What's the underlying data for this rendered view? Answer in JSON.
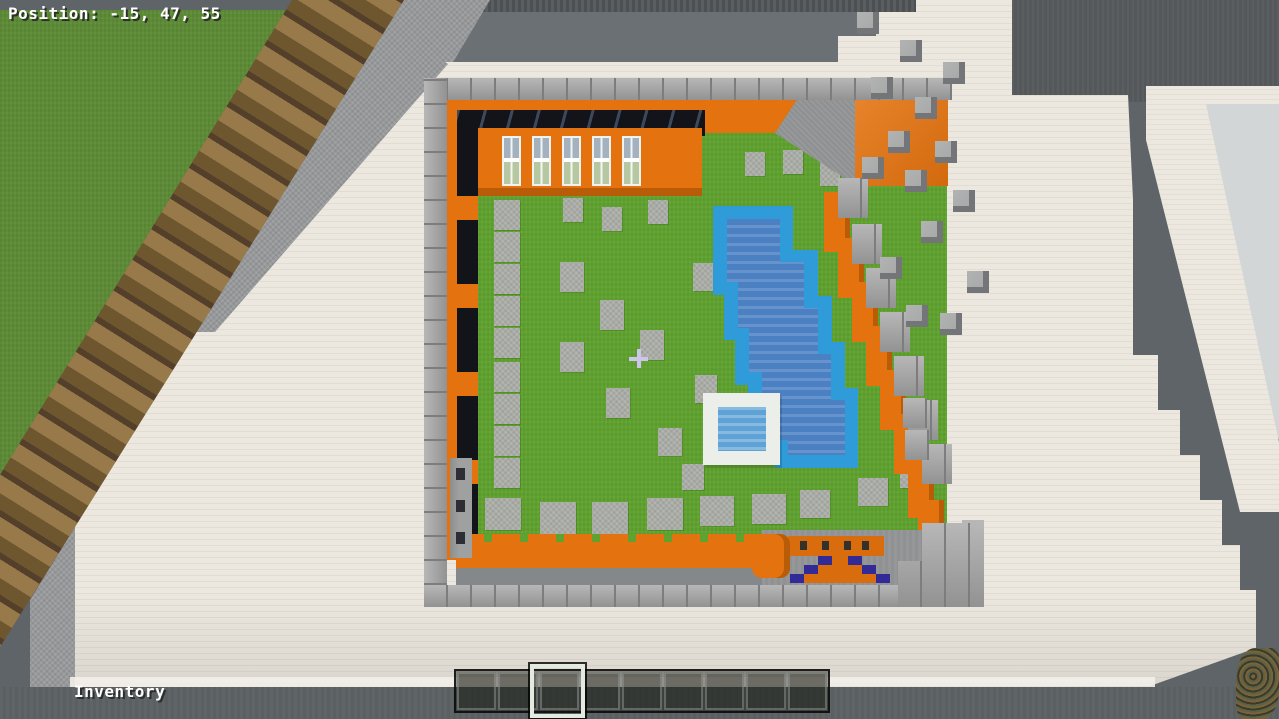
{
  "hud": {
    "position_label": "Position: -15, 47, 55",
    "inventory_label": "Inventory",
    "crosshair_icon": "+",
    "hotbar": {
      "slot_count": 9,
      "selected_slot": 3
    }
  },
  "colors": {
    "bg": "#5e6467",
    "bg_dark": "#515557",
    "bg_top_right": "#54585a",
    "stone": "#97999b",
    "quartz": "#ece8df",
    "quartz_line": "#e1ddd3",
    "light_gray": "#d3d6d7",
    "grass_outer": "#5d8c36",
    "grass": "#60a22f",
    "wood_light": "#97794a",
    "wood_mid": "#6e562f",
    "wood_dark": "#54402a",
    "brick": "#a3a3a3",
    "brick_line": "#7d7d7d",
    "orange": "#e4720e",
    "orange_dark": "#b85c08",
    "black_wall": "#13131a",
    "pool_border": "#2f9bd8",
    "pool_water": "#4b80c2",
    "small_pool_water": "#5fa3d6",
    "tile": "#a9aba5",
    "cube_top": "#a8a9a9",
    "cube_side": "#737578",
    "rug": "#d96c0c",
    "arrow_blue": "#322a96",
    "floor_gray": "#8f9193",
    "selection": "#e3ebe0",
    "crosshair": "#cdc5ec",
    "hud_text": "#ffffff"
  },
  "scene": {
    "path_tiles": [
      [
        494,
        200,
        26,
        30
      ],
      [
        494,
        232,
        26,
        30
      ],
      [
        494,
        264,
        26,
        30
      ],
      [
        494,
        296,
        26,
        30
      ],
      [
        494,
        328,
        26,
        30
      ],
      [
        494,
        362,
        26,
        30
      ],
      [
        494,
        394,
        26,
        30
      ],
      [
        494,
        426,
        26,
        30
      ],
      [
        494,
        458,
        26,
        30
      ],
      [
        563,
        198,
        20,
        24
      ],
      [
        602,
        207,
        20,
        24
      ],
      [
        648,
        200,
        20,
        24
      ],
      [
        745,
        152,
        20,
        24
      ],
      [
        783,
        150,
        20,
        24
      ],
      [
        820,
        162,
        20,
        24
      ],
      [
        560,
        262,
        24,
        30
      ],
      [
        600,
        300,
        24,
        30
      ],
      [
        560,
        342,
        24,
        30
      ],
      [
        640,
        330,
        24,
        30
      ],
      [
        606,
        388,
        24,
        30
      ],
      [
        658,
        428,
        24,
        28
      ],
      [
        693,
        263,
        22,
        28
      ],
      [
        695,
        375,
        22,
        28
      ],
      [
        682,
        464,
        22,
        26
      ],
      [
        485,
        498,
        36,
        32
      ],
      [
        540,
        502,
        36,
        32
      ],
      [
        592,
        502,
        36,
        32
      ],
      [
        647,
        498,
        36,
        32
      ],
      [
        700,
        496,
        34,
        30
      ],
      [
        752,
        494,
        34,
        30
      ],
      [
        800,
        490,
        30,
        28
      ],
      [
        858,
        478,
        30,
        28
      ],
      [
        900,
        462,
        28,
        26
      ]
    ],
    "gray_cubes": [
      [
        857,
        12
      ],
      [
        900,
        40
      ],
      [
        943,
        62
      ],
      [
        871,
        77
      ],
      [
        915,
        97
      ],
      [
        888,
        131
      ],
      [
        935,
        141
      ],
      [
        862,
        157
      ],
      [
        905,
        170
      ],
      [
        953,
        190
      ],
      [
        921,
        221
      ],
      [
        880,
        257
      ],
      [
        967,
        271
      ],
      [
        906,
        305
      ],
      [
        940,
        313
      ]
    ],
    "wall_bricks": [
      [
        838,
        178
      ],
      [
        852,
        224
      ],
      [
        866,
        268
      ],
      [
        880,
        312
      ],
      [
        894,
        356
      ],
      [
        908,
        400
      ],
      [
        922,
        444
      ]
    ],
    "wall_orange": [
      [
        824,
        192
      ],
      [
        838,
        238
      ],
      [
        852,
        282
      ],
      [
        866,
        326
      ],
      [
        880,
        370
      ],
      [
        894,
        414
      ],
      [
        908,
        458
      ],
      [
        918,
        500
      ]
    ],
    "base_bricks": [
      [
        903,
        398
      ],
      [
        905,
        430
      ]
    ],
    "windows": {
      "count": 5,
      "start_x": 24,
      "spacing": 30,
      "y": 8
    },
    "rug_marks": [
      12,
      34,
      56,
      74
    ],
    "pillar_marks": [
      10,
      42,
      74
    ],
    "arrow_rows": [
      [
        818,
        556,
        14,
        16,
        14
      ],
      [
        804,
        565,
        14,
        44,
        14
      ],
      [
        790,
        574,
        14,
        72,
        14
      ]
    ]
  }
}
